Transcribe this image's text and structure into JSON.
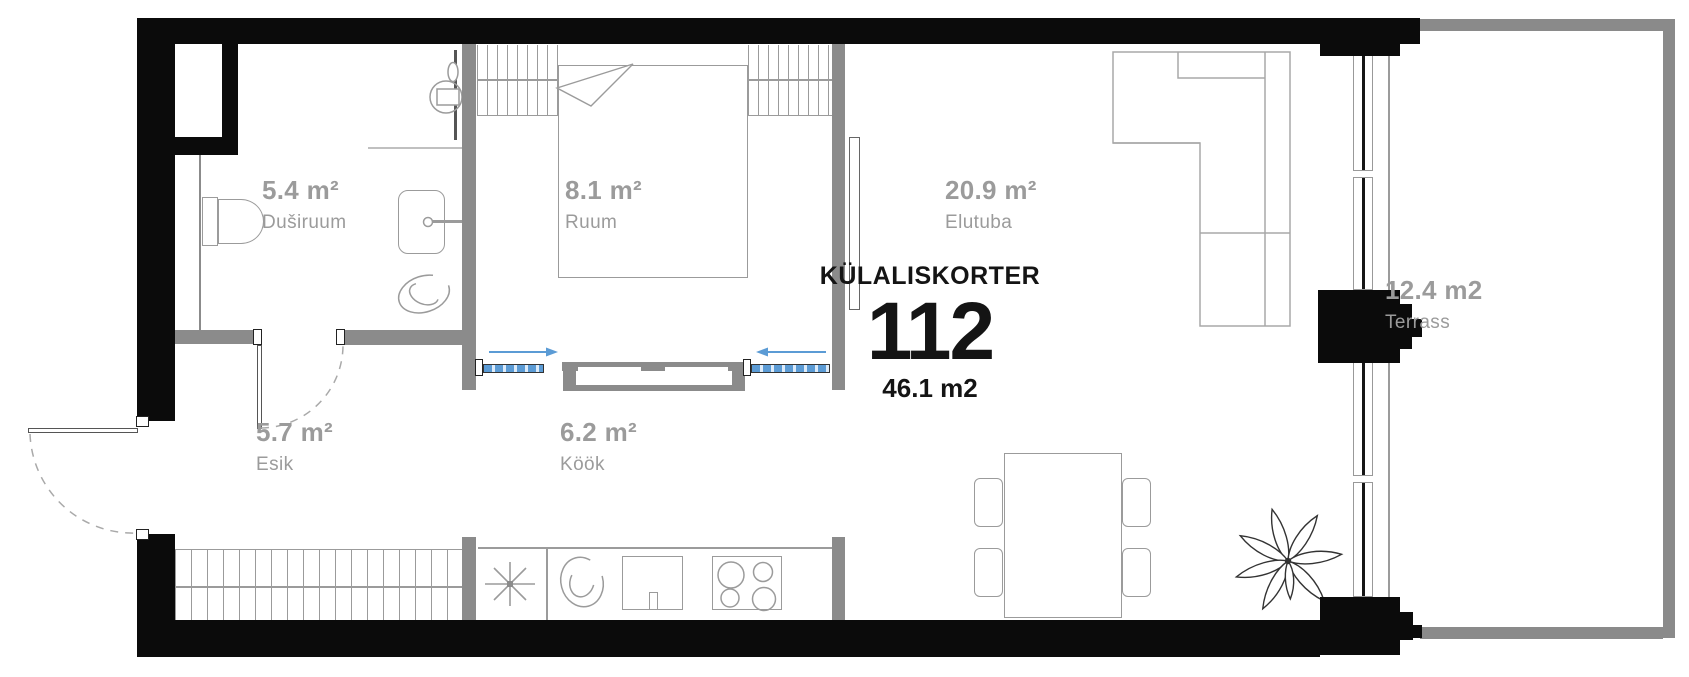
{
  "plan": {
    "type_label": "KÜLALISKORTER",
    "unit_number": "112",
    "total_area": "46.1 m2",
    "rooms": [
      {
        "area": "5.4 m²",
        "name": "Duširuum"
      },
      {
        "area": "8.1 m²",
        "name": "Ruum"
      },
      {
        "area": "20.9 m²",
        "name": "Elutuba"
      },
      {
        "area": "5.7 m²",
        "name": "Esik"
      },
      {
        "area": "6.2 m²",
        "name": "Köök"
      },
      {
        "area": "12.4 m2",
        "name": "Terrass"
      }
    ],
    "colors": {
      "exterior_wall": "#0b0b0b",
      "interior_wall": "#8b8b8b",
      "furniture_line": "#9b9b9b",
      "label_text": "#9b9b9b",
      "accent_blue": "#5b9bd5"
    }
  }
}
